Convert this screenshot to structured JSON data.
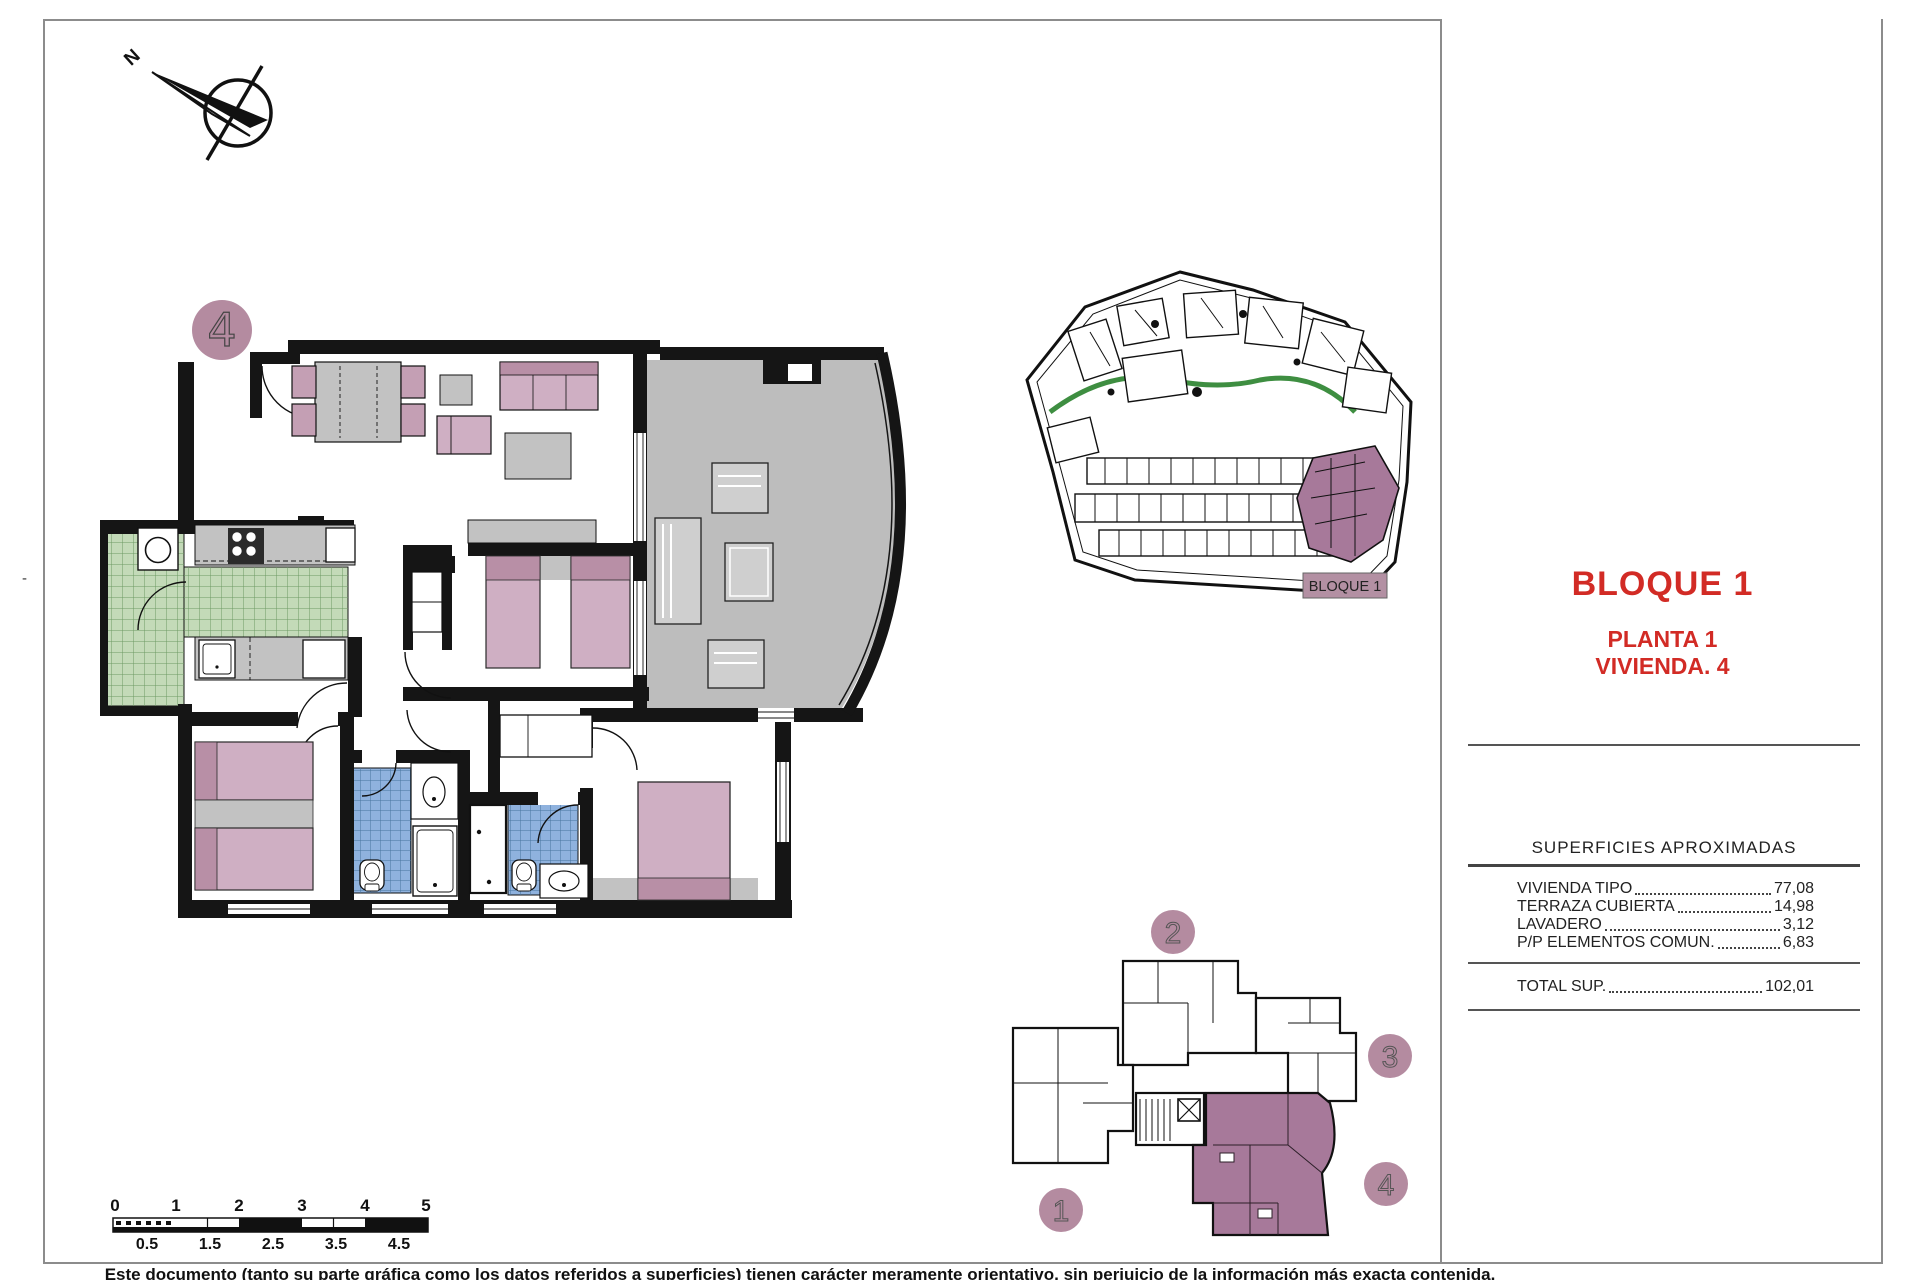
{
  "page": {
    "north_label": "N",
    "dash_mark": "-"
  },
  "floor_plan": {
    "badge": "4"
  },
  "site_plan": {
    "label": "BLOQUE 1"
  },
  "title_block": {
    "title": "BLOQUE 1",
    "line1": "PLANTA 1",
    "line2": "VIVIENDA. 4",
    "accent_color": "#d22b25"
  },
  "surfaces_table": {
    "header": "SUPERFICIES APROXIMADAS",
    "rows": [
      {
        "label": "VIVIENDA TIPO",
        "value": "77,08"
      },
      {
        "label": "TERRAZA CUBIERTA",
        "value": "14,98"
      },
      {
        "label": "LAVADERO",
        "value": "3,12"
      },
      {
        "label": "P/P ELEMENTOS COMUN.",
        "value": "6,83"
      }
    ],
    "total": {
      "label": "TOTAL SUP.",
      "value": "102,01"
    }
  },
  "key_plan": {
    "badges": [
      "1",
      "2",
      "3",
      "4"
    ],
    "highlighted_unit": "4"
  },
  "scale_bar": {
    "top_labels": [
      "0",
      "1",
      "2",
      "3",
      "4",
      "5"
    ],
    "bottom_labels": [
      "0.5",
      "1.5",
      "2.5",
      "3.5",
      "4.5"
    ]
  },
  "footer": {
    "disclaimer": "Este documento (tanto su parte gráfica como los datos referidos a superficies) tienen carácter meramente orientativo, sin perjuicio de la información más exacta contenida."
  },
  "colors": {
    "accent_red": "#d22b25",
    "mauve": "#b48ba0",
    "unit_highlight": "#a7799a",
    "terrace_gray": "#bdbdbd",
    "tile_green": "#c3dab8",
    "tile_blue": "#8fb2de",
    "furniture_pink": "#cfafc3"
  }
}
